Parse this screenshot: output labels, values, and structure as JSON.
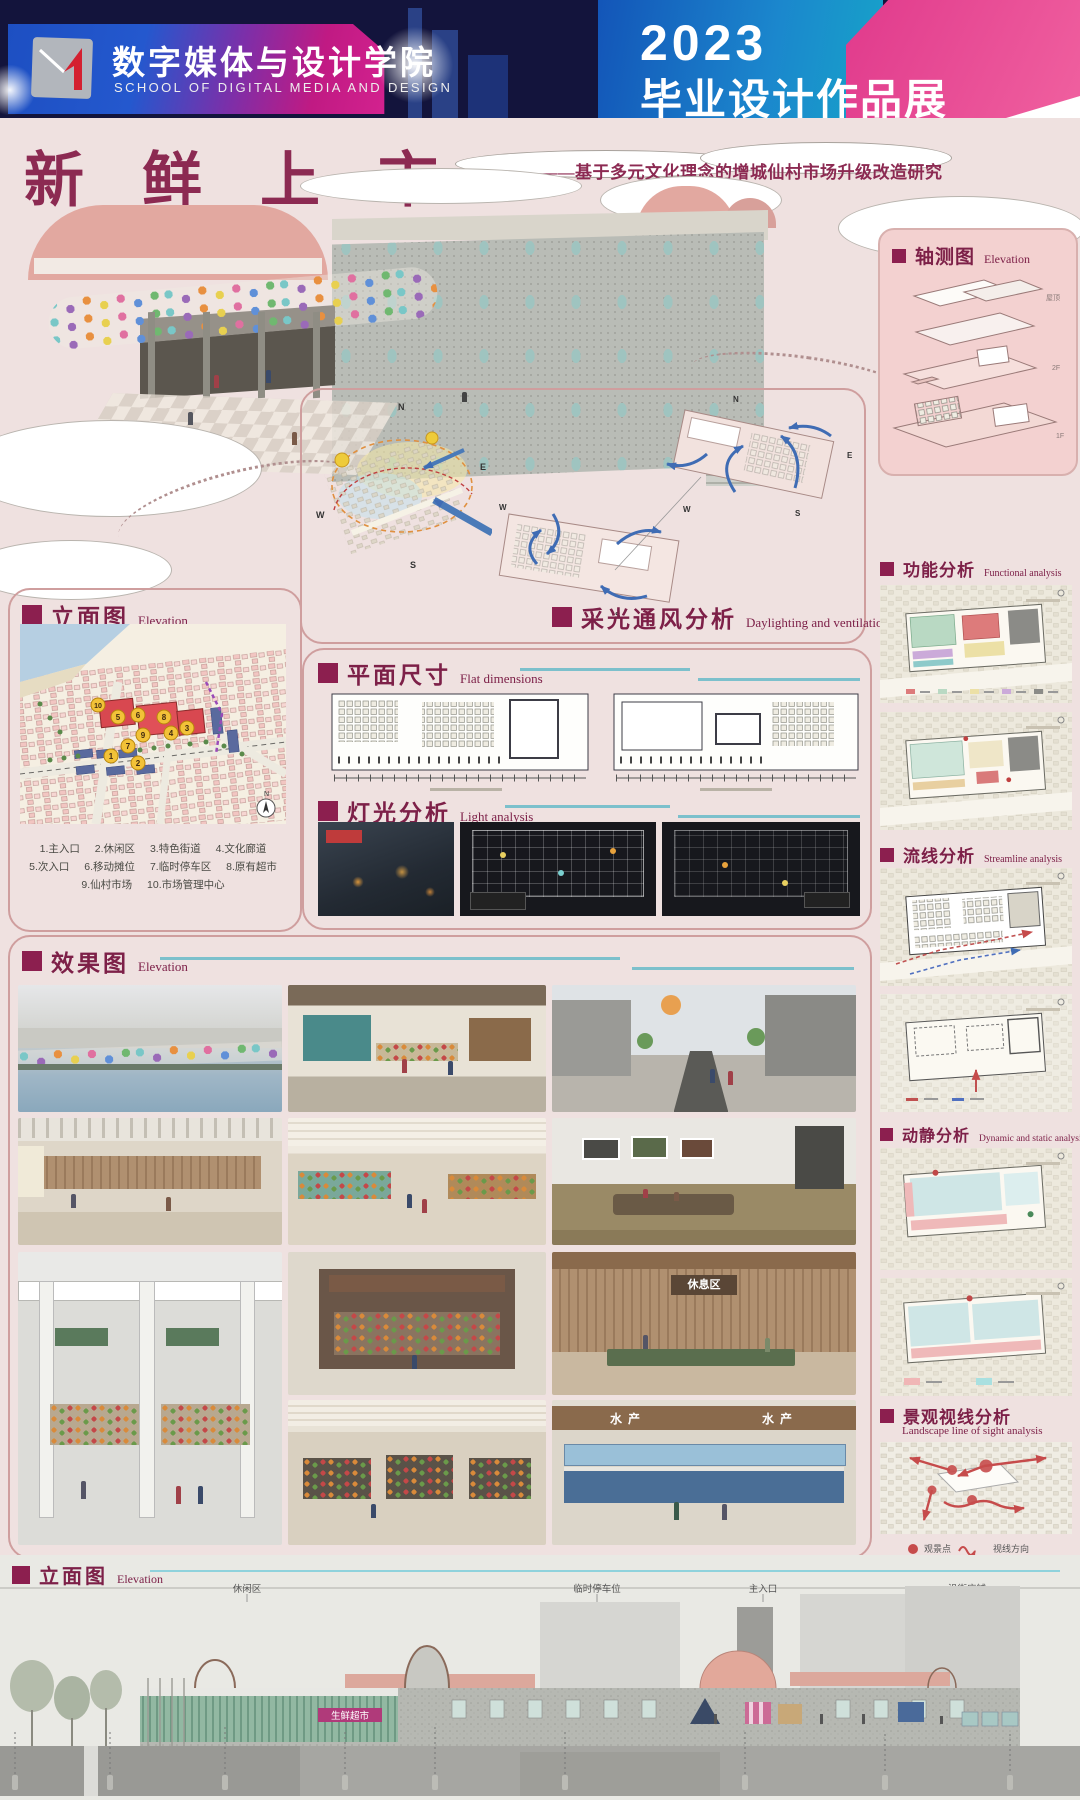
{
  "header": {
    "school_cn": "数字媒体与设计学院",
    "school_en": "SCHOOL OF DIGITAL MEDIA AND DESIGN",
    "year": "2023",
    "event": "毕业设计作品展"
  },
  "title": {
    "main": "新鲜上市",
    "dash": "——",
    "subtitle": "基于多元文化理念的增城仙村市场升级改造研究"
  },
  "sections": {
    "axon": {
      "cn": "轴测图",
      "en": "Elevation"
    },
    "daylight": {
      "cn": "采光通风分析",
      "en": "Daylighting and ventilation analysis"
    },
    "site": {
      "cn": "立面图",
      "en": "Elevation"
    },
    "flat": {
      "cn": "平面尺寸",
      "en": "Flat dimensions"
    },
    "light": {
      "cn": "灯光分析",
      "en": "Light analysis"
    },
    "functional": {
      "cn": "功能分析",
      "en": "Functional analysis"
    },
    "streamline": {
      "cn": "流线分析",
      "en": "Streamline analysis"
    },
    "dynamic": {
      "cn": "动静分析",
      "en": "Dynamic and static analysis"
    },
    "landscape": {
      "cn": "景观视线分析",
      "en": "Landscape line of sight analysis"
    },
    "renders": {
      "cn": "效果图",
      "en": "Elevation"
    },
    "elevation": {
      "cn": "立面图",
      "en": "Elevation"
    }
  },
  "axon_labels": [
    "屋顶",
    "2F",
    "1F"
  ],
  "compass": {
    "n": "N",
    "e": "E",
    "s": "S",
    "w": "W"
  },
  "site_plan": {
    "numbers": [
      "1",
      "2",
      "3",
      "4",
      "5",
      "6",
      "7",
      "8",
      "9",
      "10"
    ],
    "legend_line1": "1.主入口 2.休闲区 3.特色街道 4.文化廊道",
    "legend_line2": "5.次入口 6.移动摊位 7.临时停车区 8.原有超市",
    "legend_line3": "9.仙村市场 10.市场管理中心"
  },
  "renders": {
    "rest_sign": "休息区",
    "seafood_sign": "水产"
  },
  "landscape_legend": {
    "viewpoint": "观景点",
    "direction": "视线方向"
  },
  "elevation": {
    "top_labels": [
      "休闲区",
      "临时停车位",
      "主入口",
      "沿街店铺"
    ],
    "supermarket_sign": "生鲜超市"
  },
  "colors": {
    "accent_maroon": "#8c2a52",
    "header_navy": "#13143c",
    "accent_pink": "#e8398c",
    "accent_blue": "#1f5ecb",
    "teal_line": "#7cc0cc",
    "panel_border": "#cf9e9e"
  }
}
